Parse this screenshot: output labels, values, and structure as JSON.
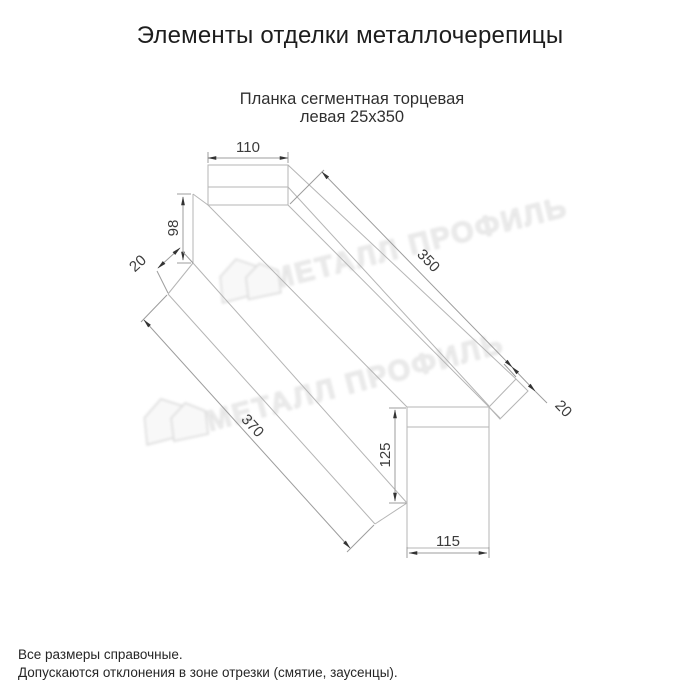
{
  "page": {
    "title": "Элементы отделки металлочерепицы"
  },
  "drawing": {
    "subtitle_line1": "Планка сегментная торцевая",
    "subtitle_line2": "левая 25х350",
    "dims": {
      "top_width": "110",
      "left_height": "98",
      "left_flange": "20",
      "top_length": "350",
      "bottom_length": "370",
      "right_height": "125",
      "bottom_width": "115",
      "right_flange": "20"
    },
    "line_color": "#b5b5b5",
    "dimension_color": "#9c9c9c",
    "text_color": "#3c3c3c"
  },
  "watermark": {
    "text": "МЕТАЛЛ ПРОФИЛЬ",
    "color": "#ebebeb"
  },
  "footer": {
    "line1": "Все размеры справочные.",
    "line2": "Допускаются отклонения в зоне отрезки (смятие, заусенцы)."
  }
}
